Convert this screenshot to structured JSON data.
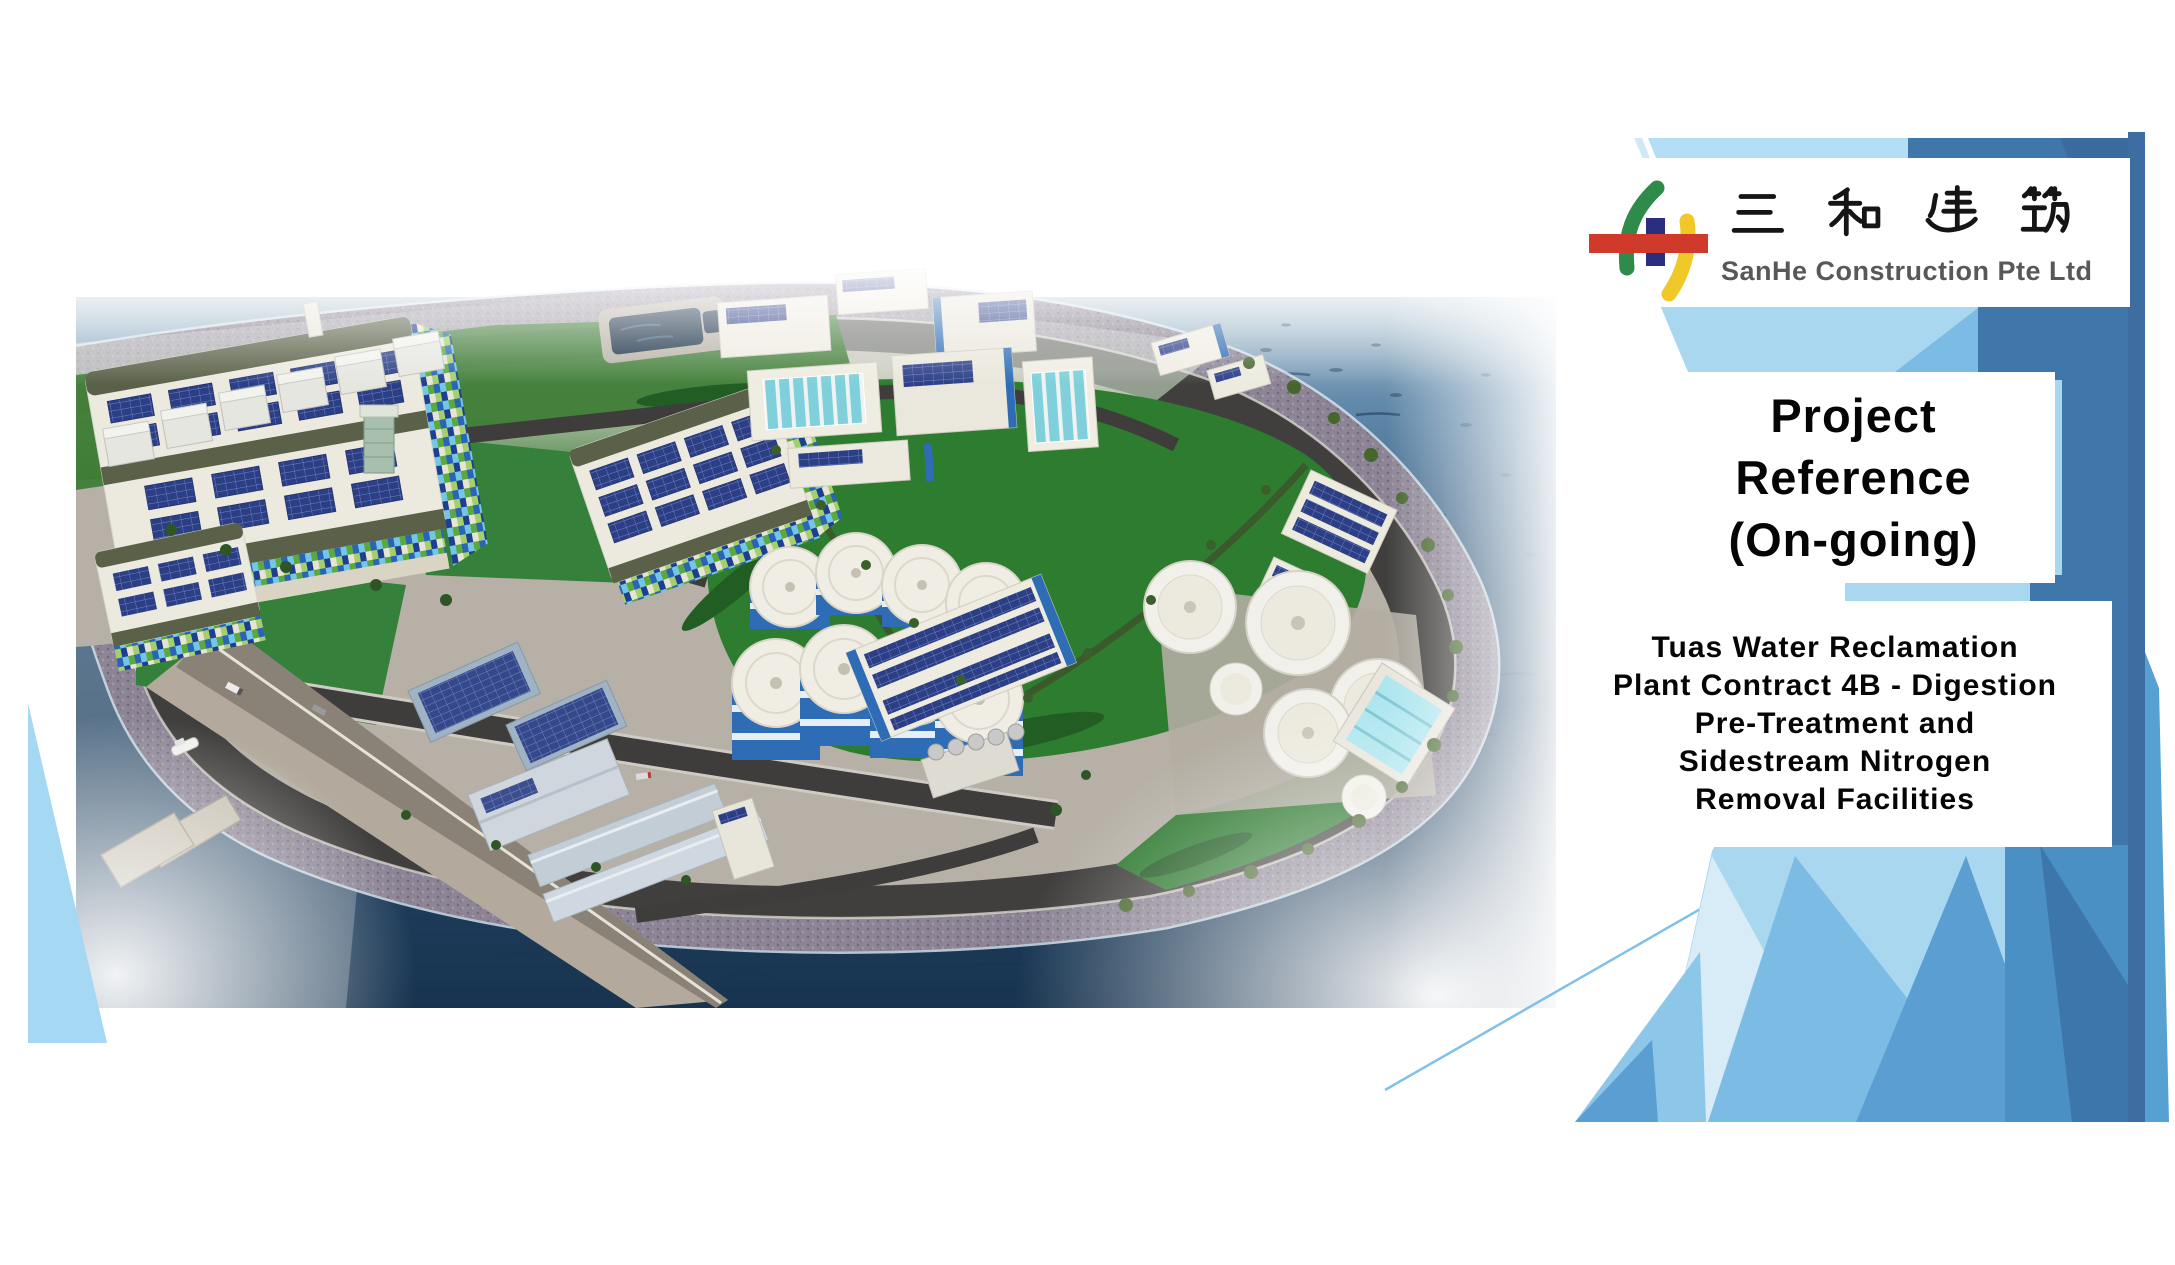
{
  "slide": {
    "logo": {
      "company_name_cn": "三和建筑",
      "company_name_en": "SanHe Construction Pte Ltd"
    },
    "title": {
      "line1": "Project",
      "line2": "Reference",
      "line3": "(On-going)",
      "full": "Project Reference (On-going)"
    },
    "project": {
      "line1": "Tuas Water Reclamation",
      "line2": "Plant Contract 4B - Digestion",
      "line3": "Pre-Treatment and",
      "line4": "Sidestream Nitrogen",
      "line5": "Removal Facilities",
      "full": "Tuas Water Reclamation Plant Contract 4B - Digestion Pre-Treatment and Sidestream Nitrogen Removal Facilities"
    },
    "image": {
      "alt": "Aerial 3D rendering of the Tuas Water Reclamation Plant on a reclaimed island surrounded by sea, with green lawns, solar-panelled buildings, blue digester silos and white tanks"
    },
    "colors": {
      "facet_lightest": "#d8ecf8",
      "facet_light": "#a9d7f0",
      "facet_medium_light": "#7cbce4",
      "facet_medium": "#5b9fd2",
      "facet_steel": "#4077aa",
      "facet_dark": "#3a689c",
      "accent_line": "#7fc2e8",
      "logo_green": "#2e8b4a",
      "logo_navy": "#2b2d7e",
      "logo_yellow": "#f0c929",
      "logo_red": "#cf3a2b",
      "title_text": "#050505",
      "company_text": "#57585a"
    }
  }
}
